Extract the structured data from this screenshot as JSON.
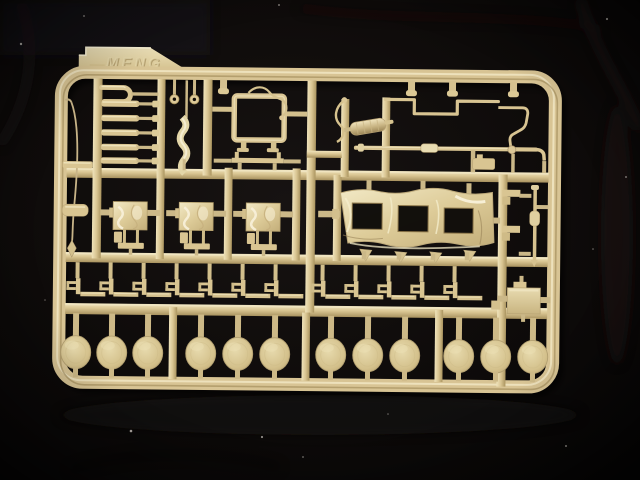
{
  "scene": {
    "subject": "injection-molded model kit sprue",
    "material": "tan styrene plastic",
    "backdrop": "black cloth"
  },
  "colors": {
    "background": "#0b0908",
    "plastic_mid": "#d9c592",
    "plastic_highlight": "#f2e8c6",
    "plastic_shadow": "#a8925f",
    "canvas_sheen": "#f8f1da"
  },
  "sprue_tab": {
    "brand_text": "MENG"
  },
  "parts": {
    "rod_parts": {
      "count": 5,
      "y_list": [
        103,
        117.5,
        132,
        146.5,
        160
      ]
    },
    "mirror_pins": {
      "count": 2,
      "x_list": [
        173,
        193
      ]
    },
    "canvas_squares": {
      "count": 3,
      "x_centers": [
        130,
        196,
        263
      ]
    },
    "rail_stubs": {
      "count": 4,
      "x_list": [
        222,
        410,
        451,
        512
      ]
    },
    "clamp_brackets": {
      "count": 12,
      "x_list": [
        78,
        111,
        144,
        177,
        210,
        243,
        276,
        323,
        356,
        389,
        422,
        455
      ]
    },
    "wheel_discs": {
      "count": 12,
      "cy": 352,
      "rx": 15,
      "ry": 16.5,
      "cx_list": [
        77,
        113,
        149,
        202,
        239,
        276,
        332,
        369,
        406,
        460,
        497,
        534
      ]
    },
    "cover_windows": {
      "count": 3
    }
  }
}
